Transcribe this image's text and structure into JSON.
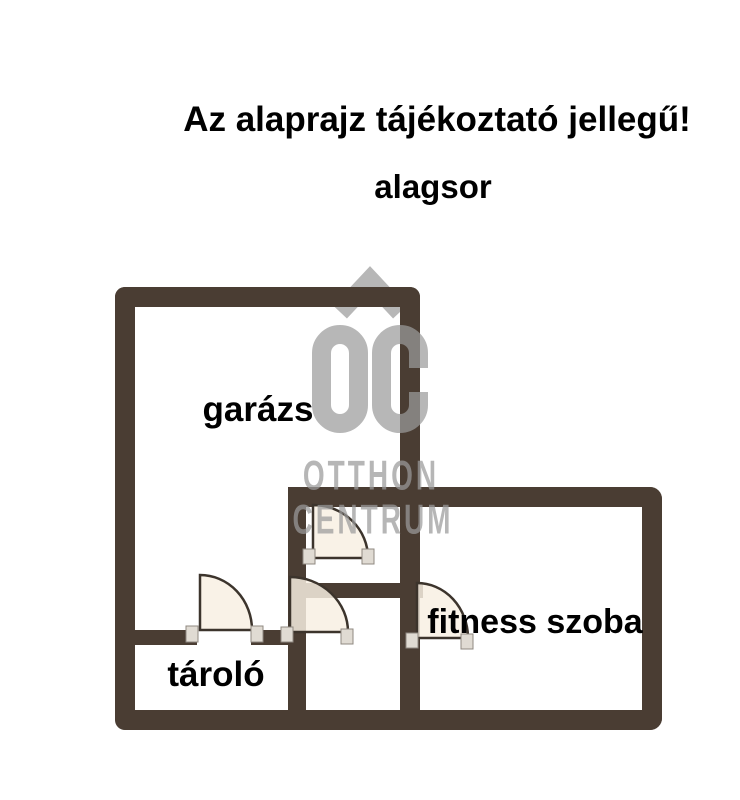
{
  "disclaimer": "Az alaprajz tájékoztató jellegű!",
  "floor_label": "alagsor",
  "rooms": {
    "garage": "garázs",
    "storage": "tároló",
    "fitness": "fitness szoba"
  },
  "watermark": {
    "monogram": "OC",
    "line1": "OTTHON",
    "line2": "CENTRUM"
  },
  "colors": {
    "wall": "#4a3d33",
    "door_fill": "#f8f0e2",
    "door_stroke": "#3c342c",
    "watermark_gray": "#9b9b9b",
    "text": "#000000",
    "background": "#ffffff"
  }
}
